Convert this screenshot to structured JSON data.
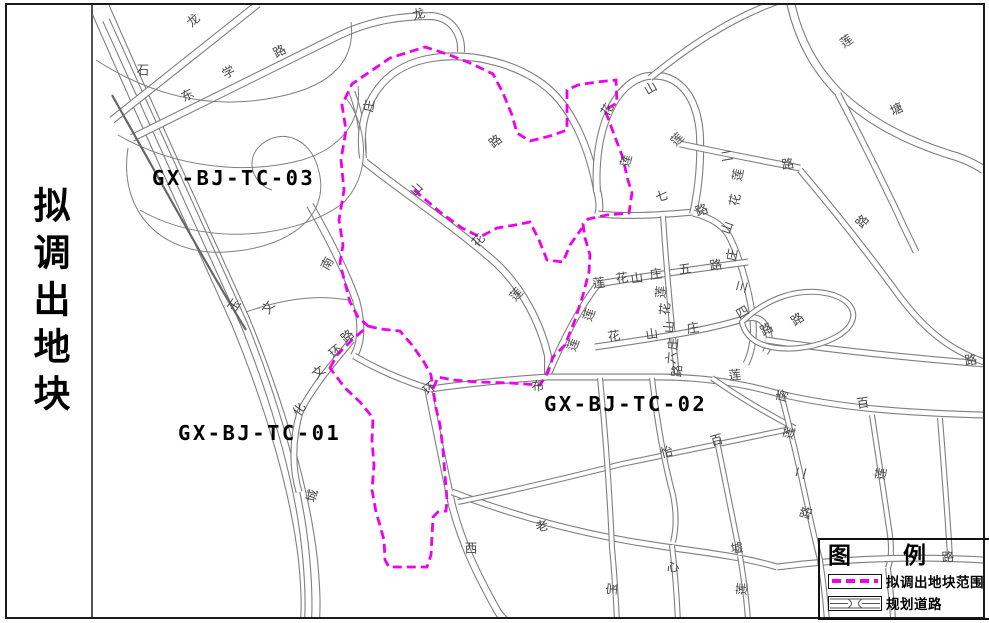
{
  "sidebar": {
    "title": "拟调出地块"
  },
  "parcel_labels": [
    {
      "id": "GX-BJ-TC-03",
      "x": 152,
      "y": 185
    },
    {
      "id": "GX-BJ-TC-01",
      "x": 178,
      "y": 440
    },
    {
      "id": "GX-BJ-TC-02",
      "x": 544,
      "y": 411
    }
  ],
  "legend": {
    "title": "图　　例",
    "items": [
      {
        "label": "拟调出地块范围",
        "type": "dashed-boundary"
      },
      {
        "label": "规划道路",
        "type": "planned-road"
      }
    ]
  },
  "colors": {
    "boundary": "#ee00ee",
    "road": "#7f7f7f",
    "road_dark": "#666666",
    "label": "#474747",
    "frame": "#1a1a1a",
    "parcel_text": "#000000"
  },
  "map": {
    "road_labels": [
      {
        "t": "龙",
        "x": 194,
        "y": 21,
        "r": -42
      },
      {
        "t": "路",
        "x": 280,
        "y": 52,
        "r": -28
      },
      {
        "t": "石",
        "x": 143,
        "y": 71,
        "r": 0
      },
      {
        "t": "学",
        "x": 229,
        "y": 73,
        "r": -28
      },
      {
        "t": "东",
        "x": 188,
        "y": 96,
        "r": -28
      },
      {
        "t": "龙",
        "x": 419,
        "y": 15,
        "r": -15
      },
      {
        "t": "庄",
        "x": 370,
        "y": 106,
        "r": -80
      },
      {
        "t": "路",
        "x": 496,
        "y": 142,
        "r": -40
      },
      {
        "t": "山",
        "x": 417,
        "y": 190,
        "r": -48
      },
      {
        "t": "花",
        "x": 479,
        "y": 241,
        "r": -48
      },
      {
        "t": "莲",
        "x": 517,
        "y": 295,
        "r": -48
      },
      {
        "t": "山",
        "x": 651,
        "y": 89,
        "r": -30
      },
      {
        "t": "花",
        "x": 608,
        "y": 110,
        "r": -60
      },
      {
        "t": "莲",
        "x": 678,
        "y": 140,
        "r": -45
      },
      {
        "t": "莲",
        "x": 627,
        "y": 161,
        "r": -75
      },
      {
        "t": "七",
        "x": 662,
        "y": 197,
        "r": -15
      },
      {
        "t": "路",
        "x": 702,
        "y": 211,
        "r": -20
      },
      {
        "t": "山",
        "x": 728,
        "y": 228,
        "r": -70
      },
      {
        "t": "庄",
        "x": 733,
        "y": 255,
        "r": -80
      },
      {
        "t": "三",
        "x": 743,
        "y": 287,
        "r": -75
      },
      {
        "t": "莲",
        "x": 847,
        "y": 42,
        "r": -35
      },
      {
        "t": "塘",
        "x": 897,
        "y": 110,
        "r": -25
      },
      {
        "t": "二",
        "x": 727,
        "y": 157,
        "r": -10
      },
      {
        "t": "路",
        "x": 788,
        "y": 165,
        "r": -10
      },
      {
        "t": "莲",
        "x": 739,
        "y": 175,
        "r": -80
      },
      {
        "t": "花",
        "x": 736,
        "y": 200,
        "r": -80
      },
      {
        "t": "路",
        "x": 863,
        "y": 222,
        "r": -50
      },
      {
        "t": "莲",
        "x": 599,
        "y": 284,
        "r": -8
      },
      {
        "t": "花",
        "x": 622,
        "y": 279,
        "r": -8
      },
      {
        "t": "山",
        "x": 637,
        "y": 279,
        "r": -8
      },
      {
        "t": "庄",
        "x": 656,
        "y": 275,
        "r": -8
      },
      {
        "t": "五",
        "x": 685,
        "y": 270,
        "r": -8
      },
      {
        "t": "路",
        "x": 716,
        "y": 266,
        "r": -8
      },
      {
        "t": "莲",
        "x": 662,
        "y": 292,
        "r": -85
      },
      {
        "t": "花",
        "x": 666,
        "y": 309,
        "r": -85
      },
      {
        "t": "山",
        "x": 670,
        "y": 327,
        "r": -85
      },
      {
        "t": "庄",
        "x": 674,
        "y": 344,
        "r": -85
      },
      {
        "t": "六",
        "x": 672,
        "y": 358,
        "r": -85
      },
      {
        "t": "路",
        "x": 678,
        "y": 371,
        "r": -85
      },
      {
        "t": "花",
        "x": 614,
        "y": 337,
        "r": -8
      },
      {
        "t": "山",
        "x": 652,
        "y": 335,
        "r": -8
      },
      {
        "t": "庄",
        "x": 693,
        "y": 329,
        "r": -8
      },
      {
        "t": "四",
        "x": 743,
        "y": 313,
        "r": -30
      },
      {
        "t": "路",
        "x": 767,
        "y": 330,
        "r": -30
      },
      {
        "t": "路",
        "x": 798,
        "y": 320,
        "r": -35
      },
      {
        "t": "莲",
        "x": 590,
        "y": 315,
        "r": -70
      },
      {
        "t": "莲",
        "x": 574,
        "y": 345,
        "r": -70
      },
      {
        "t": "路",
        "x": 971,
        "y": 361,
        "r": -8
      },
      {
        "t": "莲",
        "x": 735,
        "y": 376,
        "r": -5
      },
      {
        "t": "南",
        "x": 783,
        "y": 396,
        "r": -75
      },
      {
        "t": "百",
        "x": 863,
        "y": 404,
        "r": -8
      },
      {
        "t": "怡",
        "x": 667,
        "y": 453,
        "r": -15
      },
      {
        "t": "百",
        "x": 717,
        "y": 441,
        "r": -15
      },
      {
        "t": "莲",
        "x": 790,
        "y": 433,
        "r": -75
      },
      {
        "t": "二",
        "x": 802,
        "y": 473,
        "r": -75
      },
      {
        "t": "路",
        "x": 807,
        "y": 513,
        "r": -75
      },
      {
        "t": "莲",
        "x": 882,
        "y": 474,
        "r": -80
      },
      {
        "t": "墟",
        "x": 737,
        "y": 549,
        "r": -8
      },
      {
        "t": "心",
        "x": 673,
        "y": 568,
        "r": -10
      },
      {
        "t": "莲",
        "x": 743,
        "y": 589,
        "r": -85
      },
      {
        "t": "老",
        "x": 542,
        "y": 527,
        "r": -10
      },
      {
        "t": "西",
        "x": 471,
        "y": 549,
        "r": 0
      },
      {
        "t": "宝",
        "x": 613,
        "y": 589,
        "r": -85
      },
      {
        "t": "路",
        "x": 948,
        "y": 558,
        "r": -5
      },
      {
        "t": "南",
        "x": 328,
        "y": 264,
        "r": -60
      },
      {
        "t": "玉",
        "x": 235,
        "y": 306,
        "r": -55
      },
      {
        "t": "文",
        "x": 269,
        "y": 308,
        "r": -55
      },
      {
        "t": "路",
        "x": 348,
        "y": 337,
        "r": -40
      },
      {
        "t": "环",
        "x": 336,
        "y": 352,
        "r": -40
      },
      {
        "t": "文",
        "x": 319,
        "y": 373,
        "r": -40
      },
      {
        "t": "化",
        "x": 300,
        "y": 410,
        "r": -55
      },
      {
        "t": "城",
        "x": 313,
        "y": 496,
        "r": -75
      },
      {
        "t": "布",
        "x": 538,
        "y": 387,
        "r": -5
      },
      {
        "t": "环",
        "x": 430,
        "y": 389,
        "r": -40
      }
    ],
    "roads": [
      {
        "d": "M100,8 C140,100 190,210 240,320 C275,405 300,490 308,560 C311,592 311,606 310,622",
        "w": 20
      },
      {
        "d": "M106,20 C148,112 196,218 244,324 C277,406 300,488 306,556 C309,588 309,606 308,622",
        "w": 8
      },
      {
        "d": "M112,120 L258,4",
        "w": 8
      },
      {
        "d": "M132,138 L340,35 C372,20 402,16 432,16 C452,18 462,34 461,52",
        "w": 8
      },
      {
        "d": "M352,92 C360,114 364,136 363,158",
        "w": 7
      },
      {
        "d": "M363,158 C356,106 382,68 427,59 C474,50 526,66 553,93 C573,113 589,147 597,190 C600,202 600,210 598,215",
        "w": 8
      },
      {
        "d": "M365,162 C402,192 452,224 497,264 C521,287 540,321 548,356 L548,376",
        "w": 8
      },
      {
        "d": "M598,214 C630,217 660,215 694,212",
        "w": 7
      },
      {
        "d": "M597,192 C593,128 616,81 648,76 C681,72 698,100 700,136 C701,166 698,192 693,214",
        "w": 8
      },
      {
        "d": "M693,213 C712,218 725,226 731,240 C741,262 748,288 752,312 C755,332 753,350 746,364",
        "w": 7
      },
      {
        "d": "M548,375 C562,342 578,310 598,284",
        "w": 7
      },
      {
        "d": "M598,284 C646,276 696,269 748,262",
        "w": 7
      },
      {
        "d": "M663,216 C666,262 671,320 677,376",
        "w": 6
      },
      {
        "d": "M595,347 C648,339 700,332 740,320 C754,315 762,318 766,327 C771,336 770,346 765,353",
        "w": 7
      },
      {
        "d": "M766,340 C830,350 900,357 984,364",
        "w": 7
      },
      {
        "d": "M548,377 L660,377 C702,377 740,383 776,393 C842,409 912,413 984,415",
        "w": 7
      },
      {
        "d": "M742,322 C768,297 800,287 830,294 C856,301 861,320 841,334 C816,350 781,352 761,344 C751,340 744,332 742,322 Z",
        "w": 6
      },
      {
        "d": "M800,170 C833,209 868,253 900,297 C926,331 950,350 984,362",
        "w": 7
      },
      {
        "d": "M680,144 C718,152 758,160 800,168",
        "w": 7
      },
      {
        "d": "M790,0 C798,38 814,68 840,94 C872,124 910,142 948,154 C963,158 975,164 984,170",
        "w": 9
      },
      {
        "d": "M838,94 C858,132 878,172 898,214 C905,230 911,241 916,252",
        "w": 7
      },
      {
        "d": "M650,78 C690,45 732,18 776,2",
        "w": 7
      },
      {
        "d": "M872,415 C878,455 885,500 890,535 C892,550 891,560 888,568",
        "w": 6
      },
      {
        "d": "M428,388 C438,438 446,478 452,505 C462,545 480,580 498,612 C502,618 505,620 507,622",
        "w": 8
      },
      {
        "d": "M452,492 C520,518 590,536 660,546 C700,552 740,556 777,567",
        "w": 7
      },
      {
        "d": "M777,567 C840,559 912,556 984,560",
        "w": 7
      },
      {
        "d": "M458,502 C512,491 562,479 622,464 C682,451 740,440 795,428",
        "w": 6
      },
      {
        "d": "M600,378 C606,440 610,500 612,548 C615,578 616,600 617,622",
        "w": 6
      },
      {
        "d": "M652,378 C658,430 665,465 673,495 C677,515 676,530 673,542",
        "w": 6
      },
      {
        "d": "M672,545 C675,572 677,598 678,622",
        "w": 6
      },
      {
        "d": "M712,378 C740,398 768,414 795,428",
        "w": 6
      },
      {
        "d": "M780,390 C790,428 800,470 808,508 C813,532 817,548 820,560 C824,586 826,606 827,622",
        "w": 6
      },
      {
        "d": "M740,556 C744,580 747,600 748,622",
        "w": 6
      },
      {
        "d": "M717,441 C725,480 733,520 740,555",
        "w": 6
      },
      {
        "d": "M888,568 C891,595 893,610 893,622",
        "w": 6
      },
      {
        "d": "M940,418 C944,470 948,520 950,558",
        "w": 6
      },
      {
        "d": "M310,205 C330,240 346,272 356,300 C362,322 362,342 354,356",
        "w": 8
      },
      {
        "d": "M352,340 C332,364 312,388 300,412 C292,440 292,468 299,492",
        "w": 7
      },
      {
        "d": "M354,356 C378,370 404,381 430,389",
        "w": 7
      },
      {
        "d": "M430,389 C465,384 500,380 548,377",
        "w": 7
      }
    ],
    "road_singles": [
      "M96,60 C150,95 212,112 282,96 C332,85 356,60 351,22",
      "M118,135 C172,166 242,176 302,160 C342,148 362,120 358,86",
      "M140,210 C202,246 292,240 342,204 C370,178 370,130 346,98",
      "M128,148 C118,212 162,256 226,252 C292,248 332,214 318,168 C310,138 282,128 262,144 C244,158 252,184 272,190",
      "M246,312 C280,300 315,294 348,300"
    ],
    "dark_lines": [
      "M112,95 C160,180 208,268 246,330"
    ],
    "boundaries": [
      "M330,368 L337,355 L352,340 L368,326 L358,317 L350,302 L345,283 L340,263 L343,245 L339,220 L344,190 L341,160 L346,130 L342,105 L352,84 L390,58 L425,47 L447,54 L470,63 L493,74 L503,93 L512,115 L517,133 L530,141 L550,136 L567,130 L567,110 L567,90 L578,85 L597,82 L616,80 L617,103 L605,110 L615,137 L623,158 L627,177 L632,193 L629,213 L607,215 L588,219 L583,224 L585,238 L590,255 L589,272 L583,295 L575,320 L565,345 L553,357 L548,372 L540,385 L510,383 L477,382 L453,380 L438,377 L433,389 L436,408 L440,425 L443,450 L445,475 L447,500 L446,511 L438,512 L433,517 L431,555 L427,567 L389,567 L385,560 L384,540 L379,522 L376,512 L372,490 L374,465 L372,440 L373,418 L360,402 L345,388 Z",
      "M368,326 L380,329 L400,331 L412,345 L424,362 L431,375 L433,389",
      "M414,190 L440,212 L462,228 L480,237 L497,228 L515,225 L530,222 L539,240 L547,260 L563,262 L570,245 L582,228"
    ]
  }
}
